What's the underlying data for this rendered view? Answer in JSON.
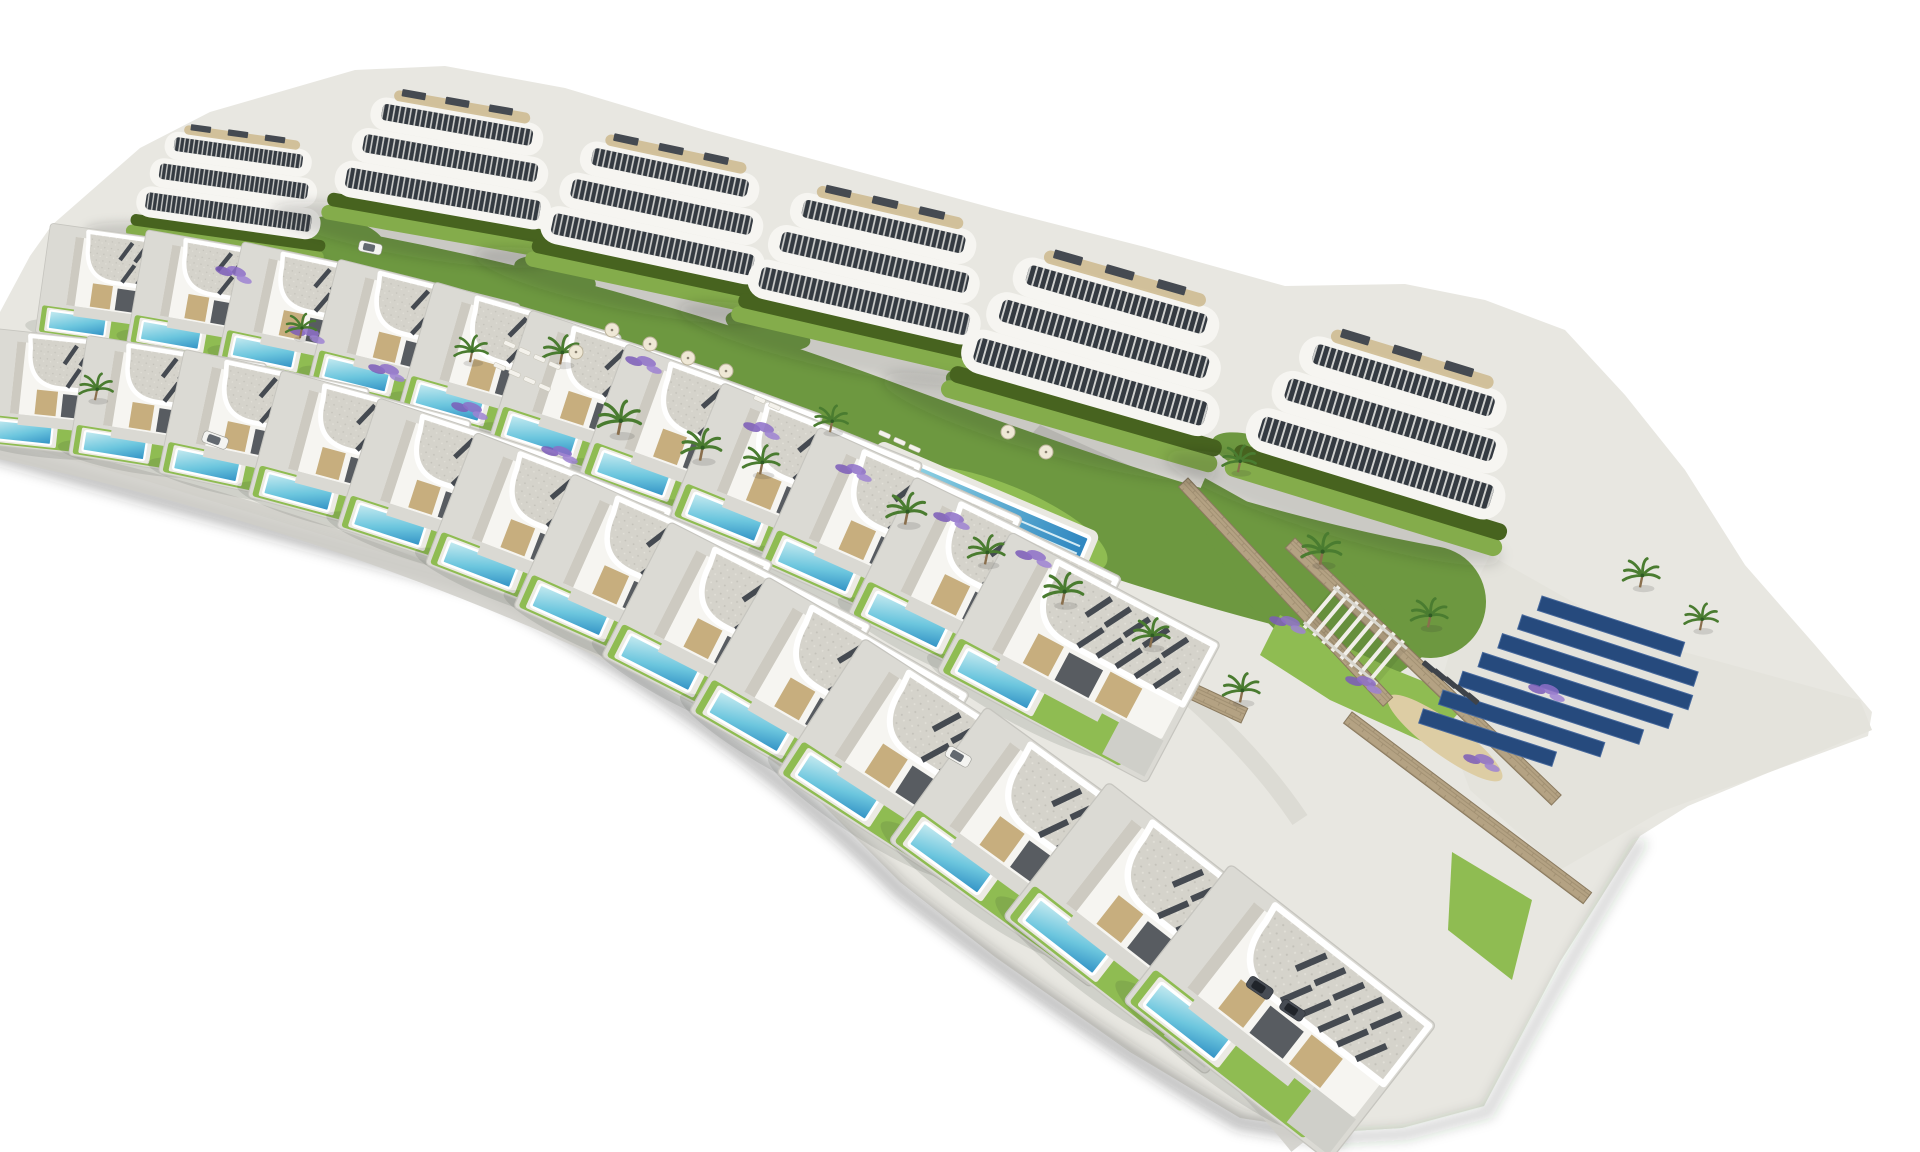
{
  "scene": {
    "kind": "aerial-architectural-render",
    "background": "#ffffff"
  },
  "palette": {
    "paper": "#ffffff",
    "ground": "#e8e7e1",
    "apron": "#e4e3dc",
    "road": "#cfcec8",
    "roadLight": "#dcdbd4",
    "grass": "#6d9840",
    "grassLight": "#84ac4b",
    "lawnBright": "#8fbc52",
    "hedge": "#47631f",
    "stone": "#b4a283",
    "stoneDark": "#8a7a5f",
    "bldg": "#f6f5f1",
    "bldgShade": "#cdcac1",
    "win": "#343a41",
    "slat": "#454a51",
    "gravel": "#d5d3cb",
    "beige": "#c7ae7e",
    "deck": "#cdb88d",
    "poolShallow": "#c9ecf1",
    "poolMid": "#6cc6de",
    "poolDeep": "#2f8fc4",
    "palm": "#4a7c30",
    "trunk": "#8a6f4d",
    "lavender": "#8b6cc4",
    "solar": "#264a7d",
    "solarEdge": "#46689c",
    "sand": "#ddcda4",
    "shadow": "rgba(45,48,44,0.30)"
  },
  "inventory": {
    "apartment_buildings": 6,
    "apartment_floors_per_building": 3,
    "detached_villas": 24,
    "private_pools": 24,
    "communal_pools": 2,
    "lap_pool_lanes": 4,
    "solar_panel_rows": 7,
    "palm_trees": 18,
    "lavender_beds": 14,
    "parasols": 7,
    "sun_loungers_white": 13,
    "sun_loungers_dark": 5,
    "cars": 5,
    "playgrounds": 1,
    "garden_pergolas": 1,
    "staircases": 1,
    "stone_walls": 7
  }
}
